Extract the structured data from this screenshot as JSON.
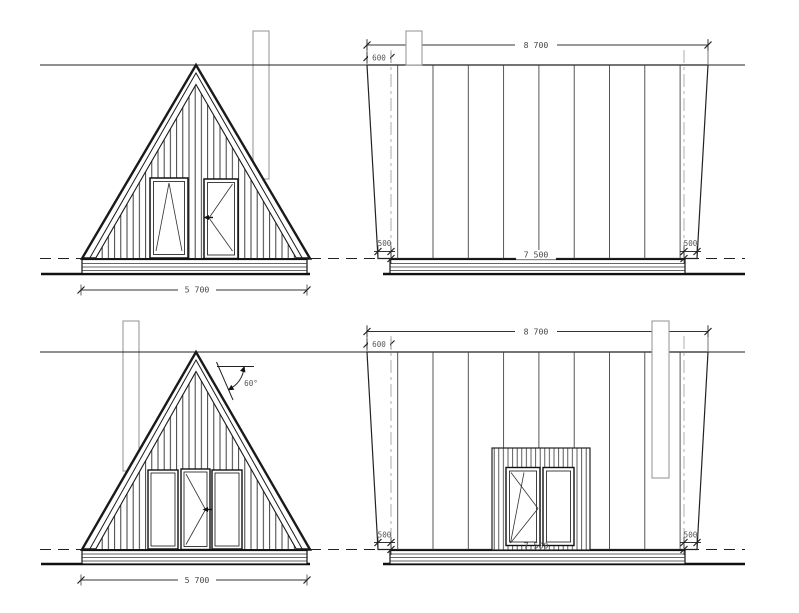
{
  "drawing": {
    "kind": "a-frame cabin elevations",
    "views": {
      "front_top": {
        "width": "5 700"
      },
      "side_top": {
        "total_width": "8 700",
        "roof_offset": "600",
        "overhang_left": "500",
        "overhang_right": "500",
        "base_width": "7 500"
      },
      "front_bottom": {
        "width": "5 700",
        "roof_angle": "60°"
      },
      "side_bottom": {
        "total_width": "8 700",
        "roof_offset": "600",
        "overhang_left": "500",
        "overhang_right": "500",
        "base_width": "7 500"
      }
    },
    "colors": {
      "background": "#ffffff",
      "main_line": "#1a1a1a",
      "dim_text": "#474747",
      "chimney_line": "#9a9a9a",
      "centerline": "#999999"
    }
  }
}
